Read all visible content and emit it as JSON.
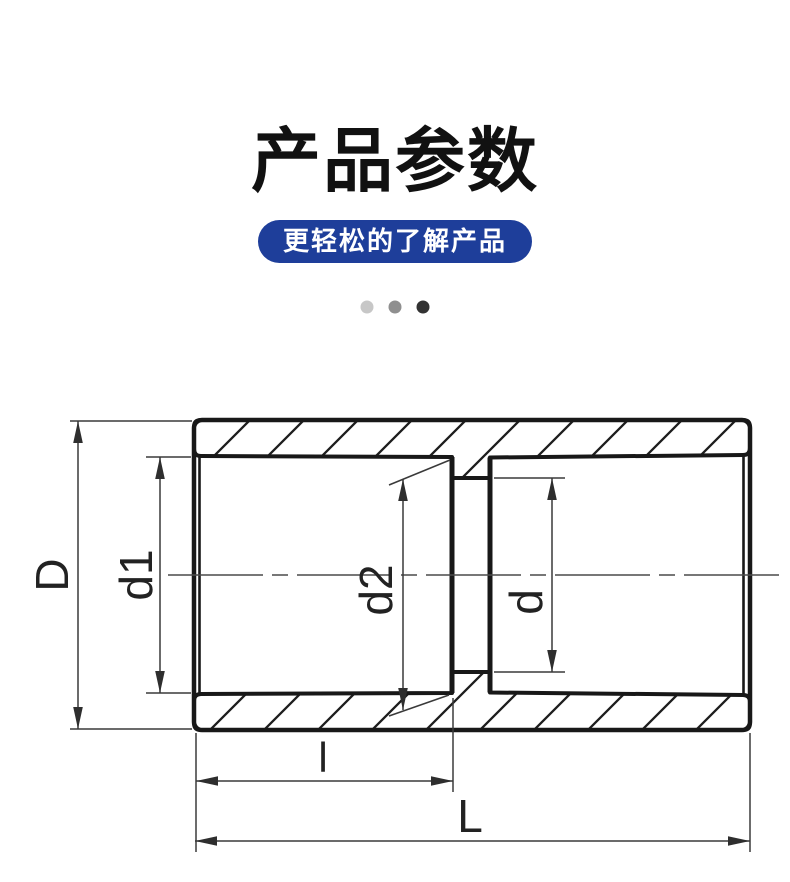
{
  "header": {
    "title": "产品参数",
    "subtitle_pill": "更轻松的了解产品"
  },
  "carousel": {
    "dots": [
      {
        "index": 1,
        "active": false,
        "color": "#c7c7c7"
      },
      {
        "index": 2,
        "active": false,
        "color": "#8f8f8f"
      },
      {
        "index": 3,
        "active": true,
        "color": "#333333"
      }
    ]
  },
  "drawing": {
    "type": "technical-section-view",
    "dimension_labels": {
      "D": "D",
      "d1": "d1",
      "d2": "d2",
      "d": "d",
      "l": "l",
      "L": "L"
    }
  },
  "colors": {
    "accent_blue": "#1e3e9a",
    "title_text": "#111111",
    "drawing_line": "#181818",
    "dimension_line": "#3a3a3a",
    "background": "#ffffff"
  }
}
